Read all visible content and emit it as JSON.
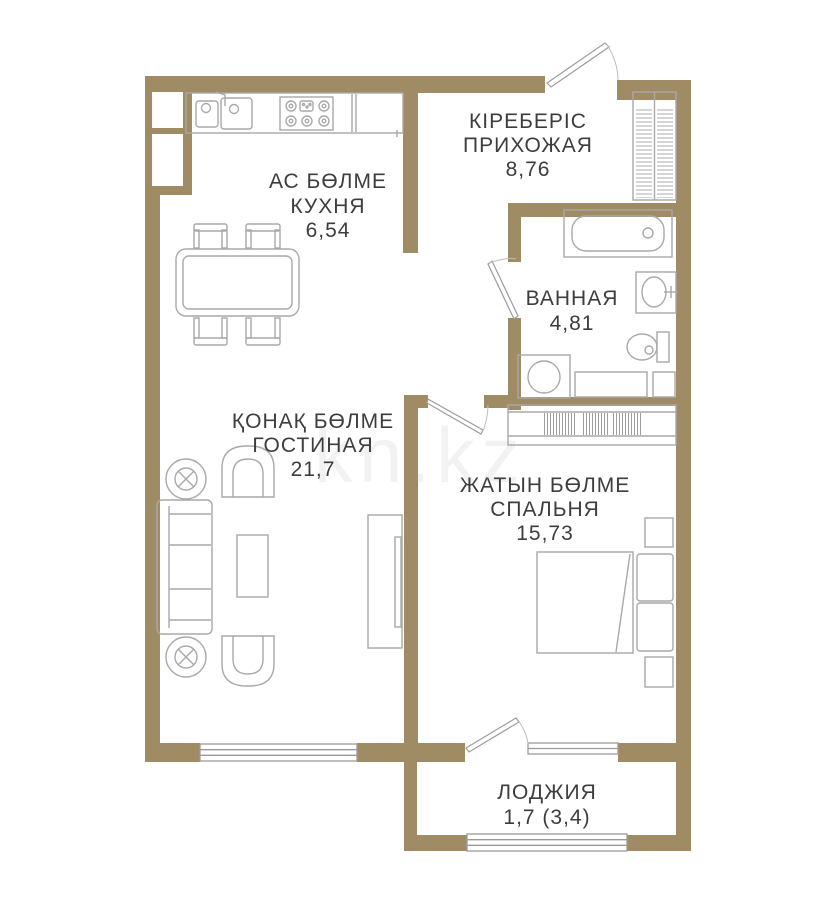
{
  "plan": {
    "type": "apartment-floor-plan",
    "colors": {
      "wall": "#9f8c65",
      "furniture_line": "#a9a9a9",
      "label_text": "#3d3d3d",
      "background": "#ffffff"
    },
    "watermark": {
      "text": "kn.kz"
    },
    "rooms": {
      "kitchen": {
        "title_kk": "АС БӨЛМЕ",
        "title_ru": "КУХНЯ",
        "area": "6,54"
      },
      "hallway": {
        "title_kk": "КІРЕБЕРІС",
        "title_ru": "ПРИХОЖАЯ",
        "area": "8,76"
      },
      "bathroom": {
        "title_ru": "ВАННАЯ",
        "area": "4,81"
      },
      "living": {
        "title_kk": "ҚОНАҚ БӨЛМЕ",
        "title_ru": "ГОСТИНАЯ",
        "area": "21,7"
      },
      "bedroom": {
        "title_kk": "ЖАТЫН БӨЛМЕ",
        "title_ru": "СПАЛЬНЯ",
        "area": "15,73"
      },
      "loggia": {
        "title_ru": "ЛОДЖИЯ",
        "area": "1,7 (3,4)"
      }
    }
  }
}
